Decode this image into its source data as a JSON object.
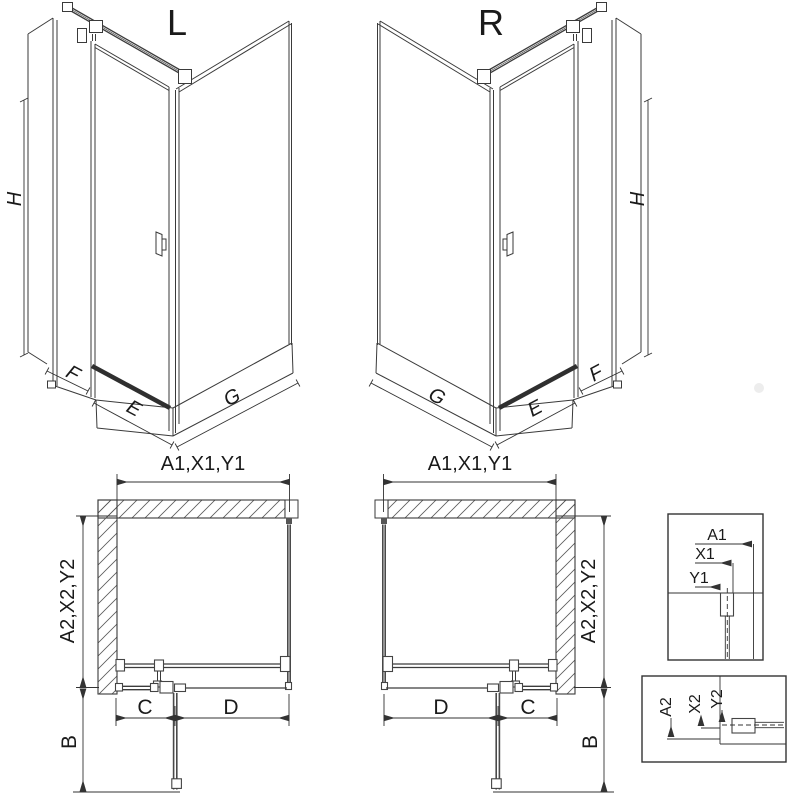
{
  "diagram": {
    "iso_left": {
      "title": "L",
      "dim_h": "H",
      "dim_f": "F",
      "dim_e": "E",
      "dim_g": "G"
    },
    "iso_right": {
      "title": "R",
      "dim_h": "H",
      "dim_f": "F",
      "dim_e": "E",
      "dim_g": "G"
    },
    "plan_left": {
      "dim_top": "A1,X1,Y1",
      "dim_side": "A2,X2,Y2",
      "dim_c": "C",
      "dim_d": "D",
      "dim_b": "B"
    },
    "plan_right": {
      "dim_top": "A1,X1,Y1",
      "dim_side": "A2,X2,Y2",
      "dim_c": "C",
      "dim_d": "D",
      "dim_b": "B"
    },
    "detail_top": {
      "dim_a1": "A1",
      "dim_x1": "X1",
      "dim_y1": "Y1"
    },
    "detail_bottom": {
      "dim_a2": "A2",
      "dim_x2": "X2",
      "dim_y2": "Y2"
    }
  },
  "colors": {
    "line": "#3a3a3a",
    "dim": "#333333",
    "background": "#ffffff"
  }
}
